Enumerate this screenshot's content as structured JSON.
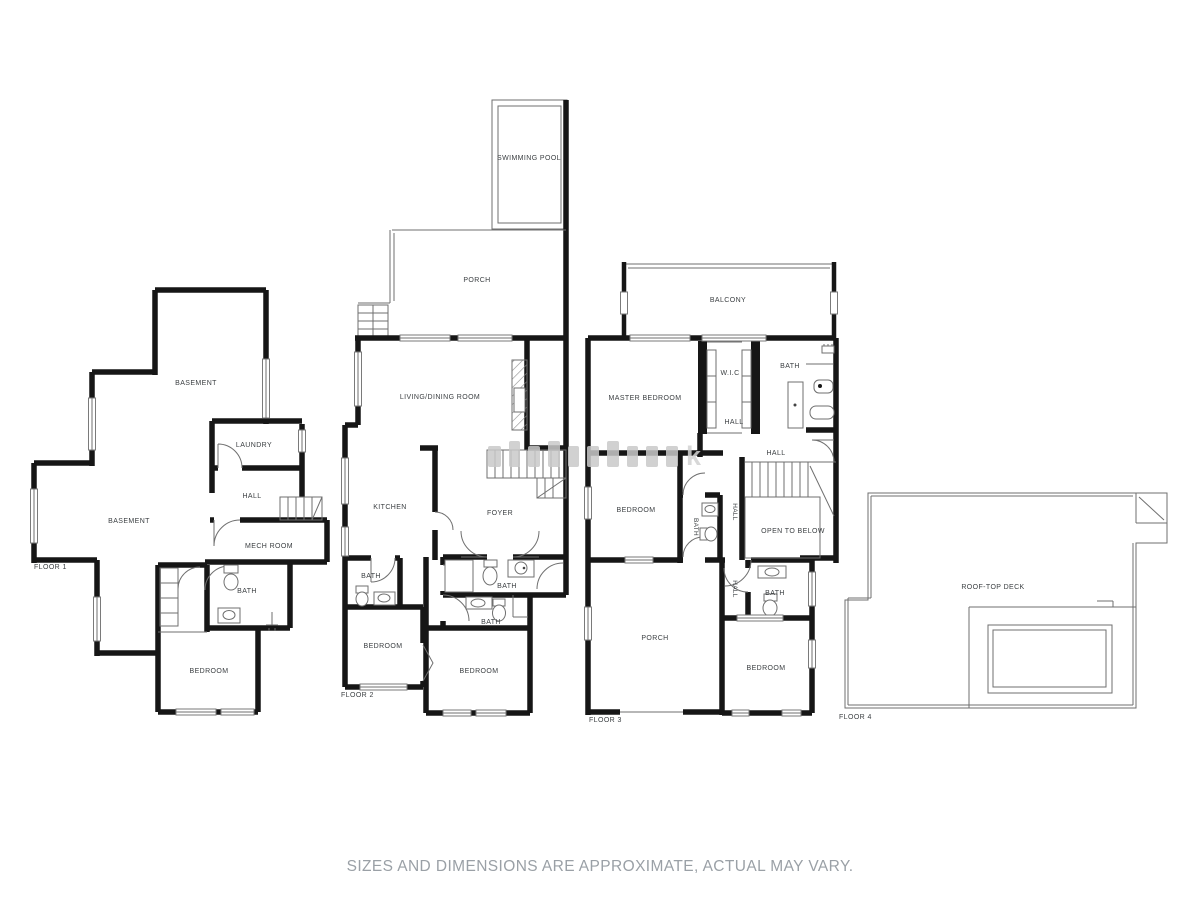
{
  "disclaimer": "SIZES AND DIMENSIONS ARE APPROXIMATE, ACTUAL MAY VARY.",
  "watermark": {
    "legible_letter": "k"
  },
  "floors": [
    {
      "label": "FLOOR 1",
      "rooms": [
        "BASEMENT",
        "LAUNDRY",
        "HALL",
        "BASEMENT",
        "MECH ROOM",
        "BATH",
        "BEDROOM"
      ]
    },
    {
      "label": "FLOOR 2",
      "rooms": [
        "SWIMMING POOL",
        "PORCH",
        "LIVING/DINING ROOM",
        "KITCHEN",
        "FOYER",
        "BATH",
        "BEDROOM",
        "BATH",
        "BATH",
        "BEDROOM"
      ]
    },
    {
      "label": "FLOOR 3",
      "rooms": [
        "BALCONY",
        "MASTER BEDROOM",
        "W.I.C",
        "BATH",
        "HALL",
        "HALL",
        "BEDROOM",
        "BATH",
        "HALL",
        "OPEN TO BELOW",
        "HALL",
        "BATH",
        "PORCH",
        "BEDROOM"
      ]
    },
    {
      "label": "FLOOR 4",
      "rooms": [
        "ROOF-TOP DECK"
      ]
    }
  ]
}
